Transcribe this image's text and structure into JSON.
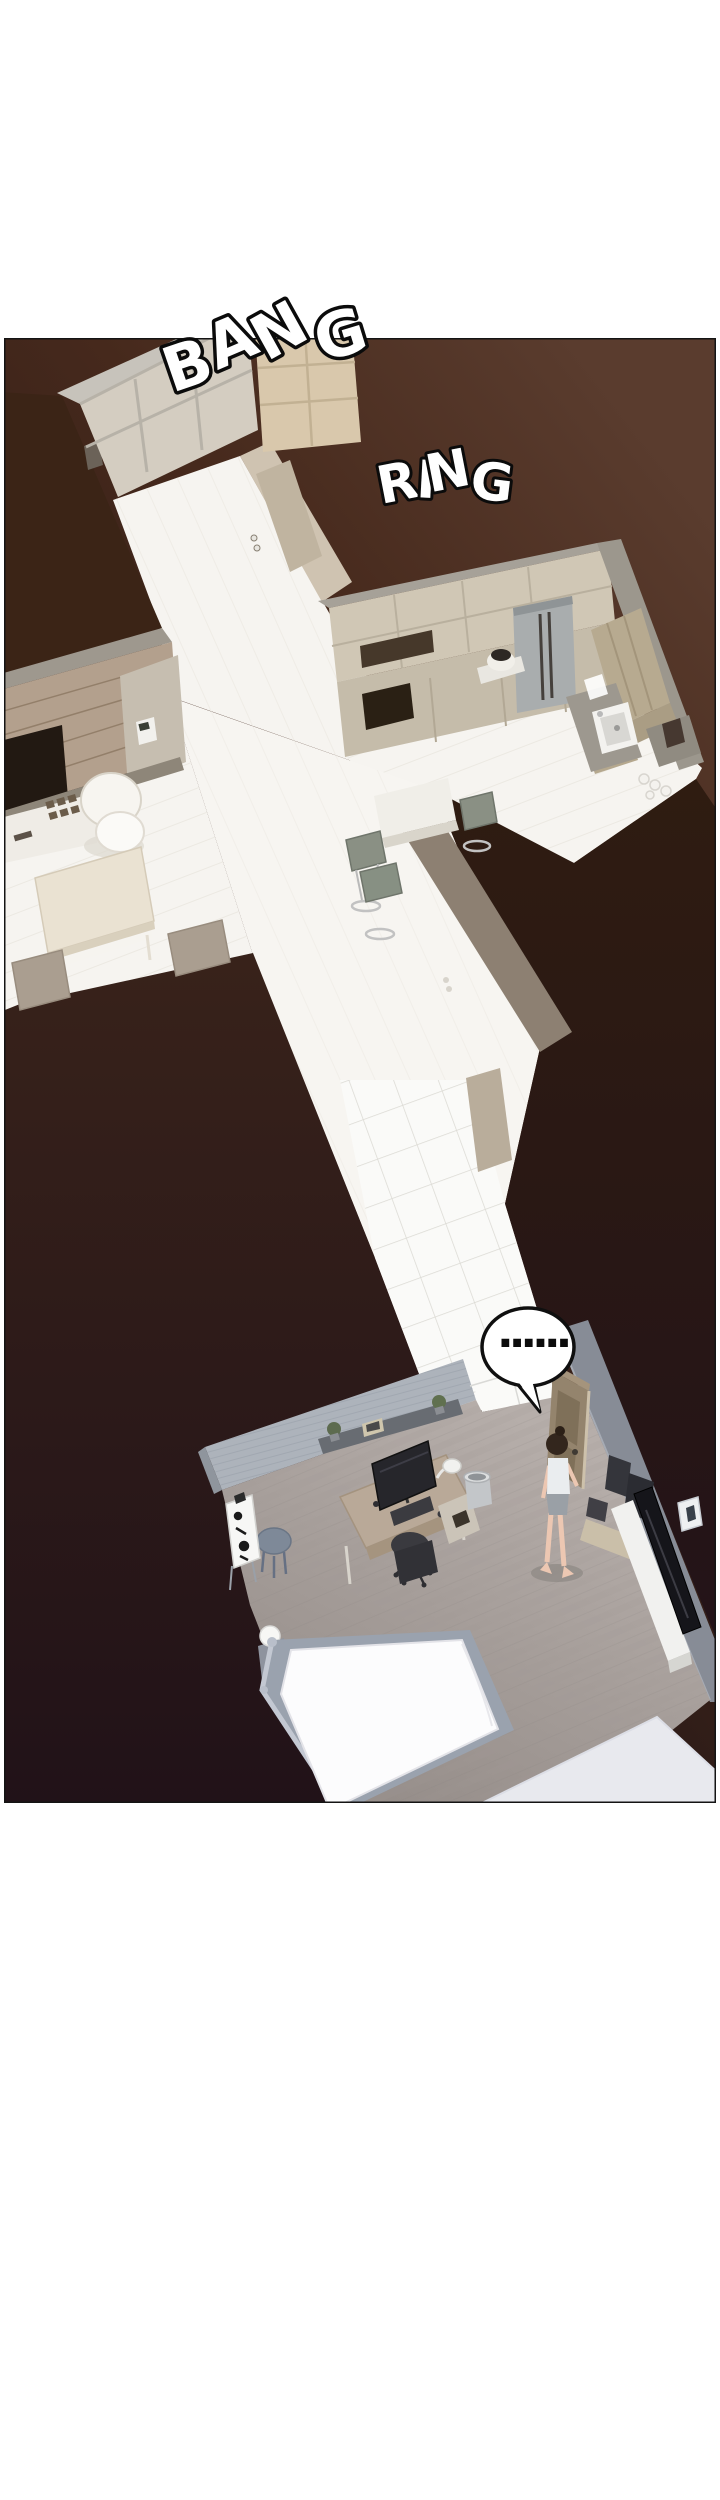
{
  "page": {
    "background": "#ffffff"
  },
  "panel": {
    "border_color": "#141414",
    "background": {
      "top_right": "#5a3c2e",
      "upper": "#46291c",
      "lower": "#301d18",
      "bottom_left": "#1b1016"
    },
    "sfx": [
      {
        "label": "bang",
        "text": "BANG",
        "fill": "#ffffff",
        "outline": "#0b0b0b"
      },
      {
        "label": "ring",
        "text": "RING",
        "fill": "#ffffff",
        "outline": "#0b0b0b"
      }
    ],
    "speech_bubble": {
      "text": "......",
      "fill": "#ffffff",
      "outline": "#0f0f0f",
      "text_color": "#0c0c0c"
    }
  },
  "scene": {
    "palette": {
      "floor_white": "#f6f4f0",
      "tile": "#fafaf8",
      "closet_beige": "#d4cdc1",
      "closet_warm": "#d9c8ac",
      "cabinet_beige": "#d0c7b5",
      "wood_wall": "#b3a08d",
      "roof_dark": "#3b2416",
      "corridor_wall_taupe": "#8d8072",
      "bedroom_wall": "#adb3bb",
      "bedroom_floor_light": "#b6aeaa",
      "bedroom_floor_dark": "#928a86",
      "bed_mattress": "#fcfcfd",
      "bed_frame": "#9aa2ae",
      "rug": "#e8e9ee",
      "tv_black": "#15151a",
      "skin": "#ecc7b2",
      "hair": "#33261d"
    }
  }
}
